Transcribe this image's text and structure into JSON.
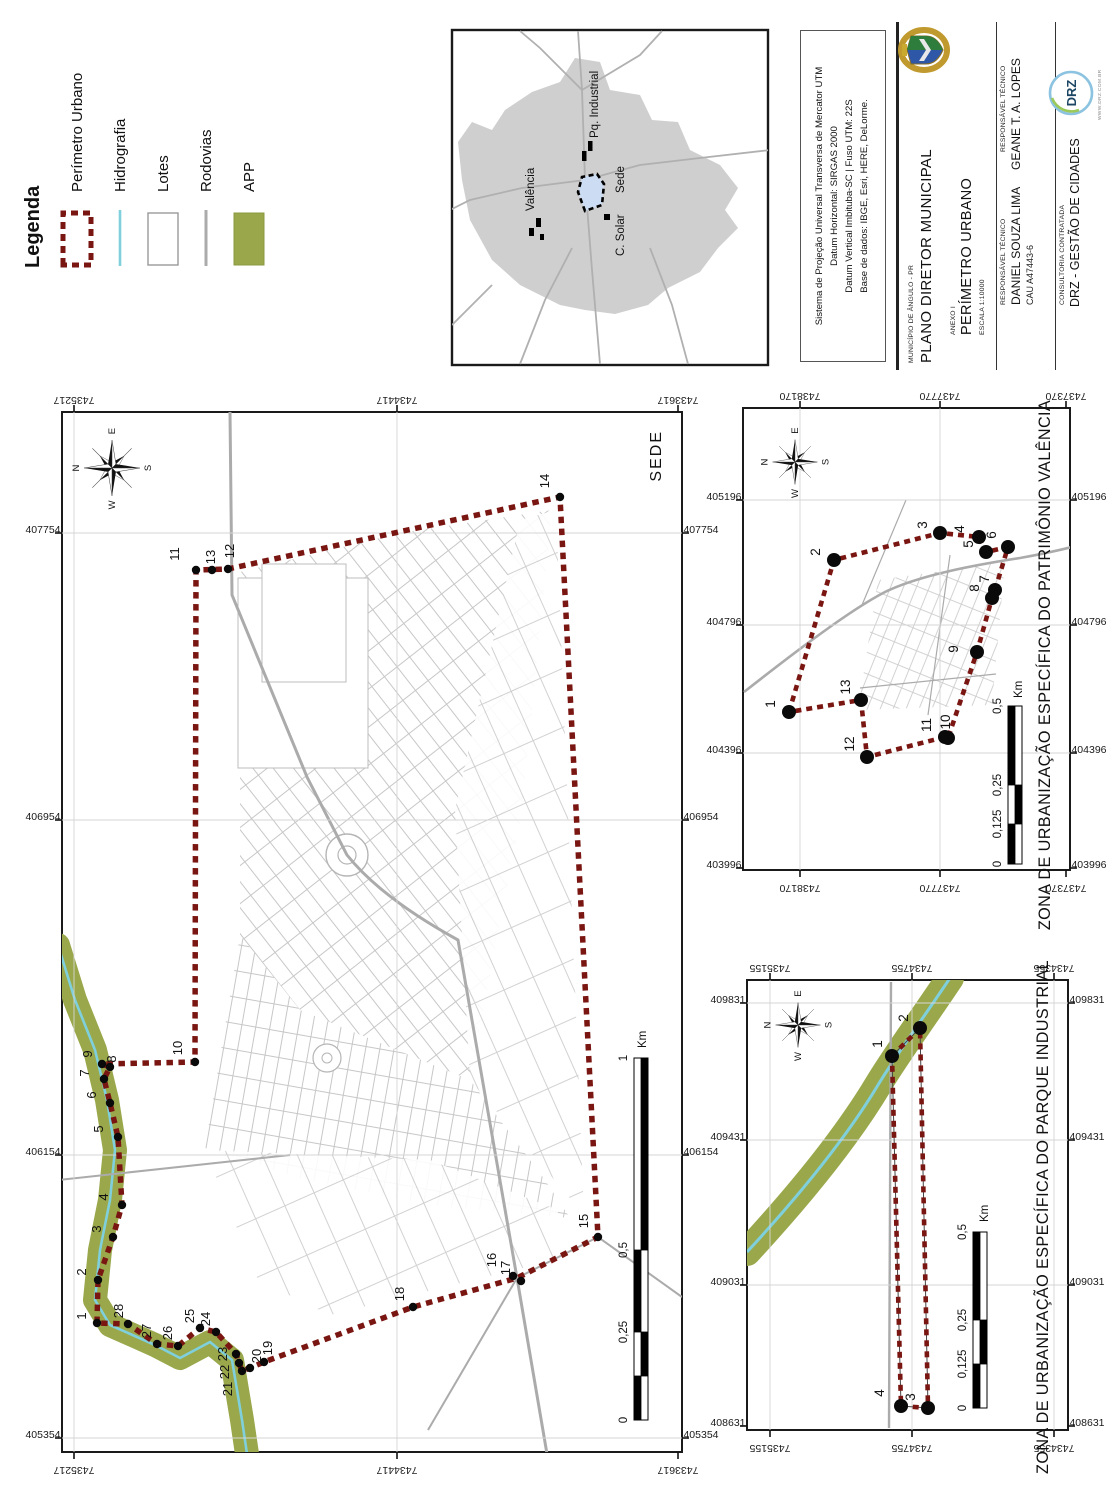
{
  "colors": {
    "perimeter": "#7a1612",
    "vertex_dot": "#0a0a0a",
    "app_green": "#9aa84b",
    "river_cyan": "#7fd0dc",
    "road_gray": "#ababab",
    "lot_outline": "#c4c4c4",
    "frame": "#1a1a1a",
    "municipality_gray": "#cfcfcf",
    "sede_fill": "#ccdcf2"
  },
  "legend": {
    "title": "Legenda",
    "items": [
      {
        "label": "Perímetro Urbano"
      },
      {
        "label": "Hidrografia"
      },
      {
        "label": "Lotes"
      },
      {
        "label": "Rodovias"
      },
      {
        "label": "APP"
      }
    ]
  },
  "overview": {
    "labels": [
      {
        "text": "Valência",
        "x": 1299,
        "y": 534
      },
      {
        "text": "Pq. Industrial",
        "x": 1372,
        "y": 598
      },
      {
        "text": "Sede",
        "x": 1317,
        "y": 624
      },
      {
        "text": "C. Solar",
        "x": 1254,
        "y": 624
      }
    ]
  },
  "title_block": {
    "projection_lines": [
      "Sistema de Projeção Universal Transversa de Mercator UTM",
      "Datum Horizontal: SIRGAS 2000",
      "Datum Vertical Imbituba-SC | Fuso UTM: 22S",
      "Base de dados: IBGE, Esri, HERE, DeLorme."
    ],
    "municipio_label": "MUNICÍPIO DE ÂNGULO - PR",
    "plano": "PLANO DIRETOR MUNICIPAL",
    "anexo": "ANEXO I",
    "anexo_title": "PERÍMETRO URBANO",
    "escala": "ESCALA 1:10000",
    "resp1_label": "RESPONSÁVEL TÉCNICO",
    "resp1_name": "DANIEL SOUZA LIMA",
    "resp1_reg": "CAU A47443-6",
    "resp2_label": "RESPONSÁVEL TÉCNICO",
    "resp2_name": "GEANE T. A. LOPES",
    "consult_label": "CONSULTORIA CONTRATADA",
    "consult_name": "DRZ - GESTÃO DE CIDADES",
    "logo_text": "DRZ",
    "logo_url": "WWW.DRZ.COM.BR"
  },
  "panels": {
    "sede": {
      "title": "SEDE",
      "title_pos": {
        "x": 1080,
        "y": 661,
        "anchor": "end",
        "size": 16,
        "ls": 2
      },
      "frame": {
        "x": 58,
        "y": 62,
        "w": 1040,
        "h": 620
      },
      "compass": {
        "cx": 1042,
        "cy": 112,
        "scale": 0.82,
        "letters": {
          "n": "N",
          "e": "E",
          "s": "S",
          "w": "W"
        }
      },
      "grid": {
        "eastings": [
          {
            "v": "405354",
            "x": 72
          },
          {
            "v": "406154",
            "x": 355
          },
          {
            "v": "406954",
            "x": 690
          },
          {
            "v": "407754",
            "x": 977
          }
        ],
        "northings": [
          {
            "v": "7435217",
            "y": 74
          },
          {
            "v": "7434417",
            "y": 397
          },
          {
            "v": "7433617",
            "y": 678
          }
        ]
      },
      "scalebar": {
        "label_y": 627,
        "unit": "Km",
        "unit_x": 462,
        "unit_y": 646,
        "stops": [
          {
            "t": "0",
            "x": 90
          },
          {
            "t": "0,25",
            "x": 178
          },
          {
            "t": "0,5",
            "x": 260
          },
          {
            "t": "1",
            "x": 452
          }
        ]
      },
      "dot_r": 4.2,
      "vfont": 13,
      "vertices": [
        {
          "n": "1",
          "x": 187,
          "y": 97,
          "tx": 194,
          "ty": 86
        },
        {
          "n": "2",
          "x": 230,
          "y": 98,
          "tx": 238,
          "ty": 86
        },
        {
          "n": "3",
          "x": 273,
          "y": 113,
          "tx": 281,
          "ty": 101
        },
        {
          "n": "4",
          "x": 305,
          "y": 122,
          "tx": 313,
          "ty": 108
        },
        {
          "n": "5",
          "x": 373,
          "y": 118,
          "tx": 381,
          "ty": 103
        },
        {
          "n": "6",
          "x": 407,
          "y": 110,
          "tx": 415,
          "ty": 96
        },
        {
          "n": "7",
          "x": 431,
          "y": 104,
          "tx": 437,
          "ty": 89
        },
        {
          "n": "8",
          "x": 443,
          "y": 110,
          "tx": 451,
          "ty": 116
        },
        {
          "n": "9",
          "x": 446,
          "y": 102,
          "tx": 456,
          "ty": 92
        },
        {
          "n": "10",
          "x": 448,
          "y": 195,
          "tx": 462,
          "ty": 182
        },
        {
          "n": "11",
          "x": 940,
          "y": 196,
          "tx": 956,
          "ty": 179
        },
        {
          "n": "12",
          "x": 941,
          "y": 228,
          "tx": 959,
          "ty": 234
        },
        {
          "n": "13",
          "x": 940,
          "y": 212,
          "tx": 953,
          "ty": 215
        },
        {
          "n": "14",
          "x": 1013,
          "y": 560,
          "tx": 1029,
          "ty": 549
        },
        {
          "n": "15",
          "x": 273,
          "y": 598,
          "tx": 289,
          "ty": 588
        },
        {
          "n": "16",
          "x": 234,
          "y": 513,
          "tx": 250,
          "ty": 496
        },
        {
          "n": "17",
          "x": 229,
          "y": 521,
          "tx": 242,
          "ty": 510
        },
        {
          "n": "18",
          "x": 203,
          "y": 413,
          "tx": 216,
          "ty": 404
        },
        {
          "n": "19",
          "x": 148,
          "y": 264,
          "tx": 162,
          "ty": 272
        },
        {
          "n": "20",
          "x": 142,
          "y": 250,
          "tx": 154,
          "ty": 261
        },
        {
          "n": "21",
          "x": 139,
          "y": 242,
          "tx": 121,
          "ty": 232
        },
        {
          "n": "22",
          "x": 147,
          "y": 239,
          "tx": 138,
          "ty": 229
        },
        {
          "n": "23",
          "x": 156,
          "y": 236,
          "tx": 156,
          "ty": 227
        },
        {
          "n": "24",
          "x": 178,
          "y": 216,
          "tx": 191,
          "ty": 210
        },
        {
          "n": "25",
          "x": 182,
          "y": 200,
          "tx": 194,
          "ty": 194
        },
        {
          "n": "26",
          "x": 164,
          "y": 178,
          "tx": 177,
          "ty": 172
        },
        {
          "n": "27",
          "x": 166,
          "y": 157,
          "tx": 179,
          "ty": 151
        },
        {
          "n": "28",
          "x": 186,
          "y": 128,
          "tx": 199,
          "ty": 123
        }
      ]
    },
    "valenca": {
      "title": "ZONA DE URBANIZAÇÃO ESPECÍFICA DO PATRIMÔNIO VALÊNCIA",
      "title_pos": {
        "x": 845,
        "y": 1050,
        "anchor": "middle",
        "size": 16.2,
        "ls": 0.4
      },
      "frame": {
        "x": 640,
        "y": 743,
        "w": 462,
        "h": 327
      },
      "compass": {
        "cx": 1048,
        "cy": 795,
        "scale": 0.66,
        "letters": {
          "n": "N",
          "e": "E",
          "s": "S",
          "w": "W"
        }
      },
      "grid": {
        "eastings": [
          {
            "v": "403996",
            "x": 642
          },
          {
            "v": "404396",
            "x": 757
          },
          {
            "v": "404796",
            "x": 885
          },
          {
            "v": "405196",
            "x": 1010
          }
        ],
        "northings": [
          {
            "v": "7438170",
            "y": 800
          },
          {
            "v": "7437770",
            "y": 940
          },
          {
            "v": "7437370",
            "y": 1066
          }
        ]
      },
      "scalebar": {
        "label_y": 1001,
        "unit": "Km",
        "unit_x": 812,
        "unit_y": 1022,
        "stops": [
          {
            "t": "0",
            "x": 646
          },
          {
            "t": "0,125",
            "x": 686
          },
          {
            "t": "0,25",
            "x": 725
          },
          {
            "t": "0,5",
            "x": 804
          }
        ]
      },
      "dot_r": 7,
      "vfont": 13.5,
      "vertices": [
        {
          "n": "1",
          "x": 798,
          "y": 789,
          "tx": 806,
          "ty": 775
        },
        {
          "n": "2",
          "x": 950,
          "y": 834,
          "tx": 958,
          "ty": 820
        },
        {
          "n": "3",
          "x": 977,
          "y": 940,
          "tx": 985,
          "ty": 927
        },
        {
          "n": "4",
          "x": 973,
          "y": 979,
          "tx": 981,
          "ty": 964
        },
        {
          "n": "5",
          "x": 958,
          "y": 986,
          "tx": 966,
          "ty": 973
        },
        {
          "n": "6",
          "x": 963,
          "y": 1008,
          "tx": 975,
          "ty": 996
        },
        {
          "n": "7",
          "x": 920,
          "y": 995,
          "tx": 931,
          "ty": 989
        },
        {
          "n": "8",
          "x": 912,
          "y": 992,
          "tx": 922,
          "ty": 979
        },
        {
          "n": "9",
          "x": 858,
          "y": 977,
          "tx": 861,
          "ty": 958
        },
        {
          "n": "10",
          "x": 772,
          "y": 948,
          "tx": 788,
          "ty": 950
        },
        {
          "n": "11",
          "x": 773,
          "y": 945,
          "tx": 785,
          "ty": 931
        },
        {
          "n": "12",
          "x": 753,
          "y": 867,
          "tx": 766,
          "ty": 854
        },
        {
          "n": "13",
          "x": 810,
          "y": 861,
          "tx": 823,
          "ty": 850
        }
      ]
    },
    "industrial": {
      "title": "ZONA DE URBANIZAÇÃO ESPECÍFICA DO PARQUE INDUSTRIAL",
      "title_pos": {
        "x": 293,
        "y": 1048,
        "anchor": "middle",
        "size": 16.2,
        "ls": 0.4
      },
      "frame": {
        "x": 80,
        "y": 747,
        "w": 450,
        "h": 321
      },
      "compass": {
        "cx": 485,
        "cy": 798,
        "scale": 0.66,
        "letters": {
          "n": "N",
          "e": "E",
          "s": "S",
          "w": "W"
        }
      },
      "grid": {
        "eastings": [
          {
            "v": "408631",
            "x": 84
          },
          {
            "v": "409031",
            "x": 225
          },
          {
            "v": "409431",
            "x": 370
          },
          {
            "v": "409831",
            "x": 507
          }
        ],
        "northings": [
          {
            "v": "7435155",
            "y": 770
          },
          {
            "v": "7434755",
            "y": 912
          },
          {
            "v": "7434355",
            "y": 1054
          }
        ]
      },
      "scalebar": {
        "label_y": 966,
        "unit": "Km",
        "unit_x": 288,
        "unit_y": 988,
        "stops": [
          {
            "t": "0",
            "x": 102
          },
          {
            "t": "0,125",
            "x": 146
          },
          {
            "t": "0,25",
            "x": 190
          },
          {
            "t": "0,5",
            "x": 278
          }
        ]
      },
      "dot_r": 7,
      "vfont": 13.5,
      "vertices": [
        {
          "n": "1",
          "x": 454,
          "y": 892,
          "tx": 466,
          "ty": 882
        },
        {
          "n": "2",
          "x": 482,
          "y": 920,
          "tx": 492,
          "ty": 908
        },
        {
          "n": "3",
          "x": 102,
          "y": 928,
          "tx": 113,
          "ty": 915
        },
        {
          "n": "4",
          "x": 104,
          "y": 901,
          "tx": 117,
          "ty": 884
        }
      ]
    }
  }
}
